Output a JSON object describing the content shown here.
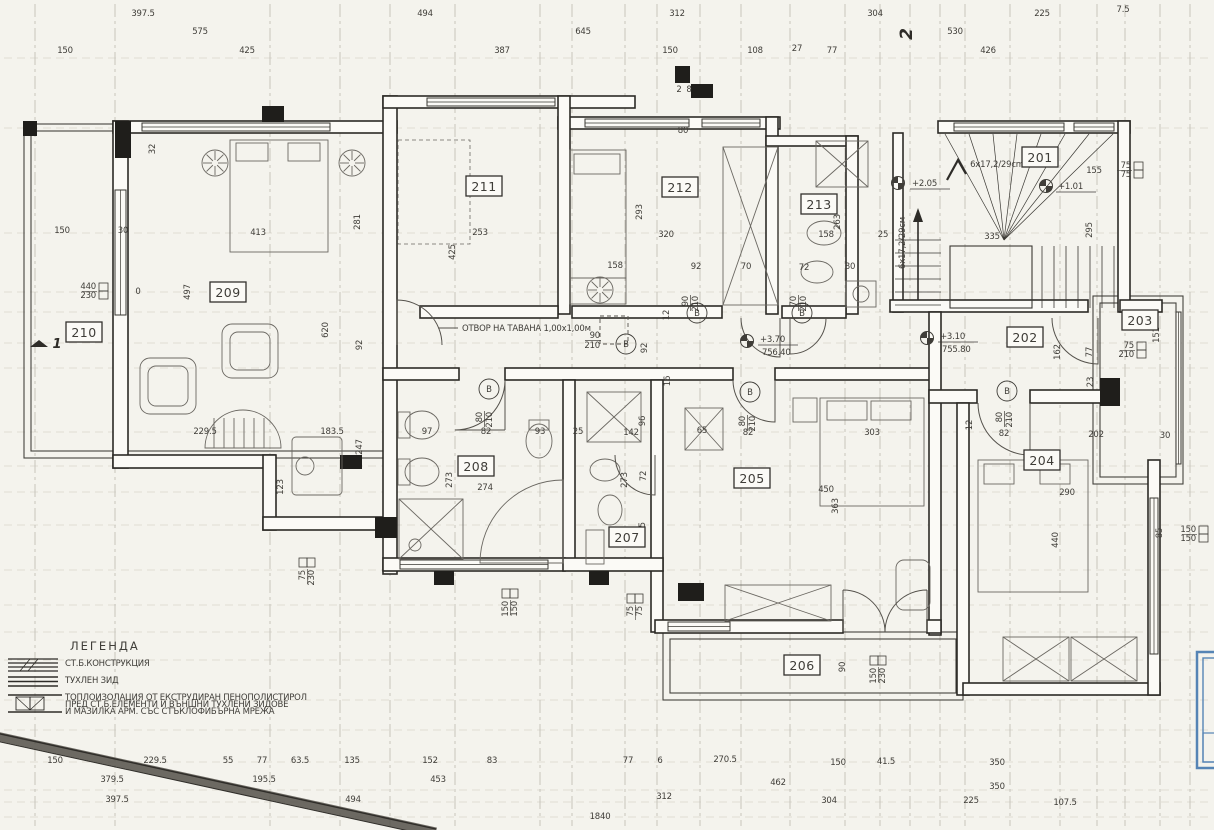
{
  "colors": {
    "paper": "#f4f3ed",
    "ink": "#3f3d38",
    "wall": "#2c2a26",
    "axis": "#b4b1a6",
    "furniture": "#6b6862",
    "stamp_blue": "#5584b5"
  },
  "rooms": [
    {
      "n": "201",
      "x": 1040,
      "y": 158
    },
    {
      "n": "202",
      "x": 1025,
      "y": 338
    },
    {
      "n": "203",
      "x": 1140,
      "y": 321
    },
    {
      "n": "204",
      "x": 1042,
      "y": 461
    },
    {
      "n": "205",
      "x": 752,
      "y": 479
    },
    {
      "n": "206",
      "x": 802,
      "y": 666
    },
    {
      "n": "207",
      "x": 627,
      "y": 538
    },
    {
      "n": "208",
      "x": 476,
      "y": 467
    },
    {
      "n": "209",
      "x": 228,
      "y": 293
    },
    {
      "n": "210",
      "x": 84,
      "y": 333
    },
    {
      "n": "211",
      "x": 484,
      "y": 187
    },
    {
      "n": "212",
      "x": 680,
      "y": 188
    },
    {
      "n": "213",
      "x": 819,
      "y": 205
    }
  ],
  "dims_top": [
    [
      "397.5",
      143,
      16
    ],
    [
      "494",
      425,
      16
    ],
    [
      "312",
      677,
      16
    ],
    [
      "304",
      875,
      16
    ],
    [
      "225",
      1042,
      16
    ],
    [
      "7.5",
      1123,
      12
    ],
    [
      "575",
      200,
      34
    ],
    [
      "645",
      583,
      34
    ],
    [
      "530",
      955,
      34
    ],
    [
      "150",
      65,
      53
    ],
    [
      "425",
      247,
      53
    ],
    [
      "387",
      502,
      53
    ],
    [
      "150",
      670,
      53
    ],
    [
      "108",
      755,
      53
    ],
    [
      "27",
      797,
      51
    ],
    [
      "77",
      832,
      53
    ],
    [
      "426",
      988,
      53
    ]
  ],
  "dims_bottom": [
    [
      "150",
      55,
      763
    ],
    [
      "229.5",
      155,
      763
    ],
    [
      "55",
      228,
      763
    ],
    [
      "77",
      262,
      763
    ],
    [
      "63.5",
      300,
      763
    ],
    [
      "135",
      352,
      763
    ],
    [
      "152",
      430,
      763
    ],
    [
      "83",
      492,
      763
    ],
    [
      "77",
      628,
      763
    ],
    [
      "6",
      660,
      763
    ],
    [
      "270.5",
      725,
      762
    ],
    [
      "150",
      838,
      765
    ],
    [
      "41.5",
      886,
      764
    ],
    [
      "350",
      997,
      765
    ],
    [
      "379.5",
      112,
      782
    ],
    [
      "195.5",
      264,
      782
    ],
    [
      "453",
      438,
      782
    ],
    [
      "462",
      778,
      785
    ],
    [
      "350",
      997,
      789
    ],
    [
      "397.5",
      117,
      802
    ],
    [
      "494",
      353,
      802
    ],
    [
      "312",
      664,
      799
    ],
    [
      "304",
      829,
      803
    ],
    [
      "225",
      971,
      803
    ],
    [
      "107.5",
      1065,
      805
    ],
    [
      "1840",
      600,
      819
    ]
  ],
  "dims_inner": [
    [
      "150",
      62,
      233
    ],
    [
      "30",
      123,
      233
    ],
    [
      "413",
      258,
      235
    ],
    [
      "497",
      190,
      292,
      1
    ],
    [
      "620",
      328,
      330,
      1
    ],
    [
      "281",
      360,
      222,
      1
    ],
    [
      "92",
      362,
      345,
      1
    ],
    [
      "32",
      155,
      149,
      1
    ],
    [
      "229.5",
      205,
      434
    ],
    [
      "183.5",
      332,
      434
    ],
    [
      "247",
      362,
      447,
      1
    ],
    [
      "123",
      283,
      487,
      1
    ],
    [
      "0",
      138,
      294
    ],
    [
      "253",
      480,
      235
    ],
    [
      "425",
      455,
      252,
      1
    ],
    [
      "158",
      615,
      268
    ],
    [
      "92",
      696,
      269
    ],
    [
      "70",
      746,
      269
    ],
    [
      "72",
      804,
      270
    ],
    [
      "293",
      642,
      212,
      1
    ],
    [
      "320",
      666,
      237
    ],
    [
      "80",
      683,
      133
    ],
    [
      "158",
      826,
      237
    ],
    [
      "25",
      883,
      237
    ],
    [
      "263",
      840,
      222,
      1
    ],
    [
      "80",
      850,
      269
    ],
    [
      "155",
      1094,
      173
    ],
    [
      "335",
      992,
      239
    ],
    [
      "295",
      1092,
      230,
      1
    ],
    [
      "97",
      427,
      434
    ],
    [
      "82",
      486,
      434
    ],
    [
      "93",
      540,
      434
    ],
    [
      "25",
      578,
      434
    ],
    [
      "142",
      631,
      435
    ],
    [
      "96",
      645,
      421,
      1
    ],
    [
      "273",
      452,
      480,
      1
    ],
    [
      "274",
      485,
      490
    ],
    [
      "273",
      627,
      480,
      1
    ],
    [
      "72",
      646,
      476,
      1
    ],
    [
      "105",
      645,
      530,
      1
    ],
    [
      "65",
      702,
      433
    ],
    [
      "82",
      748,
      435
    ],
    [
      "303",
      872,
      435
    ],
    [
      "450",
      826,
      492
    ],
    [
      "363",
      838,
      506,
      1
    ],
    [
      "92",
      647,
      348,
      1
    ],
    [
      "16",
      670,
      381,
      1
    ],
    [
      "12",
      669,
      315,
      1
    ],
    [
      "162",
      1060,
      352,
      1
    ],
    [
      "77",
      1092,
      352,
      1
    ],
    [
      "23",
      1093,
      382,
      1
    ],
    [
      "202",
      1096,
      437
    ],
    [
      "30",
      1165,
      438
    ],
    [
      "82",
      1004,
      436
    ],
    [
      "290",
      1067,
      495
    ],
    [
      "440",
      1058,
      540,
      1
    ],
    [
      "85",
      1162,
      533,
      1
    ],
    [
      "151",
      1159,
      335,
      1
    ],
    [
      "12",
      972,
      425,
      1
    ],
    [
      "90",
      845,
      667,
      1
    ],
    [
      "2",
      679,
      92
    ],
    [
      "8",
      689,
      92
    ]
  ],
  "annotations": [
    {
      "t": "ОТВОР НА ТАВАНА 1,00x1,00м",
      "x": 462,
      "y": 331,
      "a": "start",
      "s": 9.5
    },
    {
      "t": "6x17,2/29cm",
      "x": 997,
      "y": 167,
      "s": 8
    },
    {
      "t": "6x17,2/29см",
      "x": 905,
      "y": 243,
      "s": 8,
      "r": 1
    },
    {
      "t": "2",
      "x": 912,
      "y": 34,
      "s": 17,
      "r": 1,
      "hand": 1
    },
    {
      "t": "1",
      "x": 57,
      "y": 348,
      "s": 13,
      "hand": 1
    }
  ],
  "levels": [
    {
      "v": "+2.05",
      "x": 912,
      "y": 186,
      "cx": 898,
      "cy": 183
    },
    {
      "v": "+1.01",
      "x": 1058,
      "y": 189,
      "cx": 1046,
      "cy": 186
    },
    {
      "v": "+3.70",
      "sub": "756.40",
      "x": 760,
      "y": 342,
      "cx": 747,
      "cy": 341
    },
    {
      "v": "+3.10",
      "sub": "755.80",
      "x": 940,
      "y": 339,
      "cx": 927,
      "cy": 338
    }
  ],
  "door_markers": [
    {
      "w": "90",
      "h": "210",
      "x": 600,
      "y": 338,
      "cx": 626,
      "cy": 344,
      "L": "В"
    },
    {
      "w": "90",
      "h": "210",
      "x": 688,
      "y": 296,
      "cx": 697,
      "cy": 313,
      "L": "В",
      "r": 1
    },
    {
      "w": "70",
      "h": "210",
      "x": 796,
      "y": 296,
      "cx": 802,
      "cy": 313,
      "L": "В",
      "r": 1
    },
    {
      "w": "80",
      "h": "210",
      "x": 482,
      "y": 412,
      "cx": 489,
      "cy": 389,
      "L": "В",
      "r": 1
    },
    {
      "w": "80",
      "h": "210",
      "x": 745,
      "y": 416,
      "cx": 750,
      "cy": 392,
      "L": "В",
      "r": 1
    },
    {
      "w": "80",
      "h": "210",
      "x": 1002,
      "y": 412,
      "cx": 1007,
      "cy": 391,
      "L": "В",
      "r": 1
    }
  ],
  "window_markers": [
    {
      "a": "440",
      "b": "230",
      "x": 96,
      "y": 290,
      "v": 0
    },
    {
      "a": "75",
      "b": "230",
      "x": 306,
      "y": 570,
      "v": 1
    },
    {
      "a": "150",
      "b": "150",
      "x": 509,
      "y": 601,
      "v": 1
    },
    {
      "a": "75",
      "b": "75",
      "x": 634,
      "y": 606,
      "v": 1
    },
    {
      "a": "150",
      "b": "230",
      "x": 877,
      "y": 668,
      "v": 1
    },
    {
      "a": "150",
      "b": "150",
      "x": 1196,
      "y": 533,
      "v": 0
    },
    {
      "a": "75",
      "b": "75",
      "x": 1131,
      "y": 169,
      "v": 0
    },
    {
      "a": "75",
      "b": "210",
      "x": 1134,
      "y": 349,
      "v": 0
    }
  ],
  "legend": {
    "title": "ЛЕГЕНДА",
    "items": [
      {
        "lines": [
          "СТ.Б.КОНСТРУКЦИЯ"
        ]
      },
      {
        "lines": [
          "ТУХЛЕН ЗИД"
        ]
      },
      {
        "lines": [
          "ТОПЛОИЗОЛАЦИЯ ОТ ЕКСТРУДИРАН ПЕНОПОЛИСТИРОЛ",
          "ПРЕД СТ.Б.ЕЛЕМЕНТИ И ВЪНШНИ ТУХЛЕНИ ЗИДОВЕ",
          "И МАЗИЛКА АРМ. СЪС СТЪКЛОФИБЪРНА МРЕЖА"
        ]
      }
    ]
  }
}
